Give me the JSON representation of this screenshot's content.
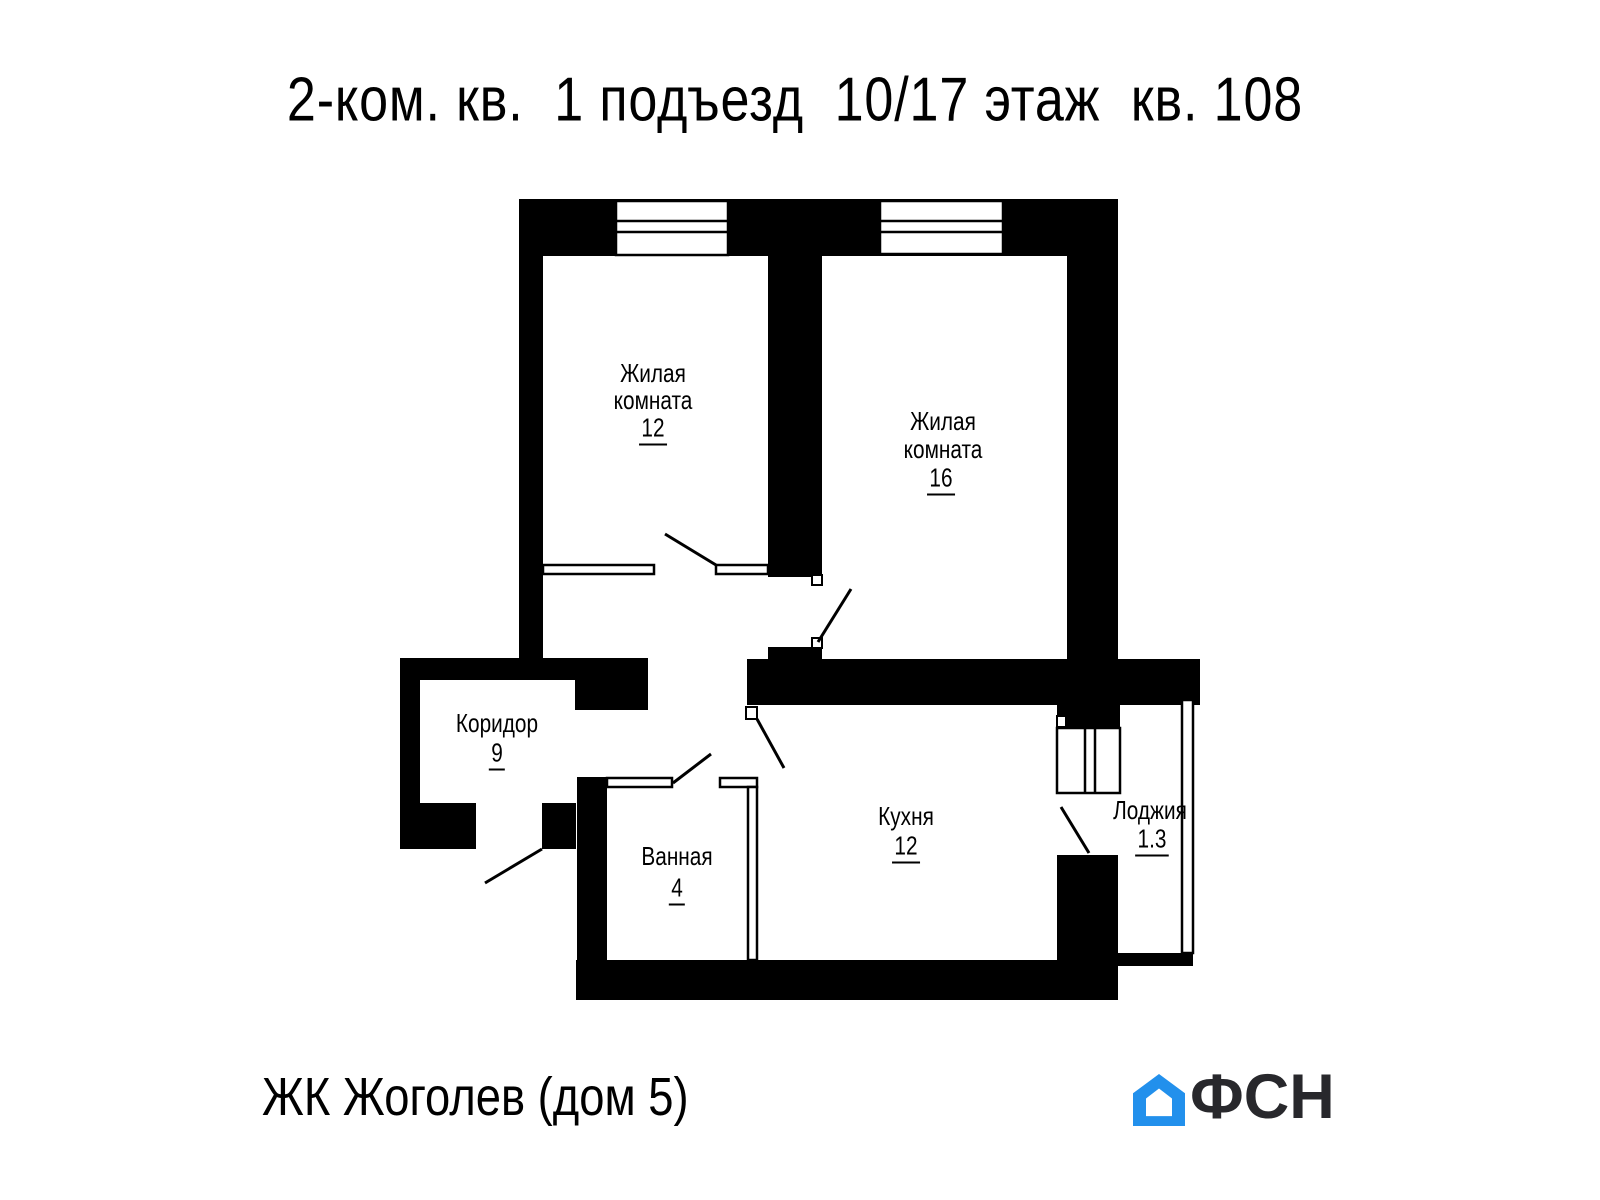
{
  "title": "2-ком. кв.  1 подъезд  10/17 этаж  кв. 108",
  "rooms": {
    "living1": {
      "line1": "Жилая",
      "line2": "комната",
      "area": "12"
    },
    "living2": {
      "line1": "Жилая",
      "line2": "комната",
      "area": "16"
    },
    "corridor": {
      "name": "Коридор",
      "area": "9"
    },
    "bathroom": {
      "name": "Ванная",
      "area": "4"
    },
    "kitchen": {
      "name": "Кухня",
      "area": "12"
    },
    "loggia": {
      "name": "Лоджия",
      "area": "1.3"
    }
  },
  "footer": {
    "project": "ЖК Жоголев (дом 5)"
  },
  "logo": {
    "text": "ФСН",
    "color": "#2290EC",
    "text_color": "#28282c"
  },
  "colors": {
    "wall": "#000000",
    "background": "#ffffff"
  }
}
